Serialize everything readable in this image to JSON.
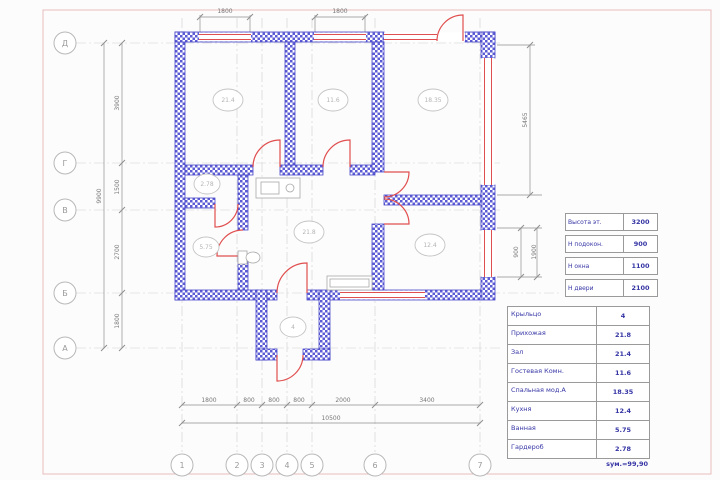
{
  "plan": {
    "axes_left": [
      "Д",
      "Г",
      "В",
      "Б",
      "А"
    ],
    "axes_bottom": [
      "1",
      "2",
      "3",
      "4",
      "5",
      "6",
      "7"
    ],
    "room_tags": [
      "21.4",
      "11.6",
      "18.35",
      "2.78",
      "5.75",
      "21.8",
      "12.4",
      "4"
    ]
  },
  "dims": {
    "window_top_1": "1800",
    "window_top_2": "1800",
    "left_segments": [
      "3900",
      "1500",
      "2700",
      "1800"
    ],
    "left_total": "9900",
    "bottom_segments": [
      "1800",
      "800",
      "800",
      "800",
      "2000",
      "3400"
    ],
    "bottom_total": "10500",
    "right_height": "5465",
    "right_win_offset": "900",
    "right_win": "1900"
  },
  "spec_table": {
    "rows": [
      {
        "label": "Высота эт.",
        "value": "3200"
      },
      {
        "label": "Н подокон.",
        "value": "900"
      },
      {
        "label": "Н окна",
        "value": "1100"
      },
      {
        "label": "Н двери",
        "value": "2100"
      }
    ]
  },
  "room_table": {
    "rows": [
      {
        "label": "Крыльцо",
        "value": "4"
      },
      {
        "label": "Прихожая",
        "value": "21.8"
      },
      {
        "label": "Зал",
        "value": "21.4"
      },
      {
        "label": "Гостевая Комн.",
        "value": "11.6"
      },
      {
        "label": "Спальная мод.А",
        "value": "18.35"
      },
      {
        "label": "Кухня",
        "value": "12.4"
      },
      {
        "label": "Ванная",
        "value": "5.75"
      },
      {
        "label": "Гардероб",
        "value": "2.78"
      }
    ],
    "total": "sум.=99,90"
  },
  "colors": {
    "wall_blue": "#5b5bd6",
    "opening_red": "#e04f4f",
    "dim_gray": "#8f8f8f"
  }
}
